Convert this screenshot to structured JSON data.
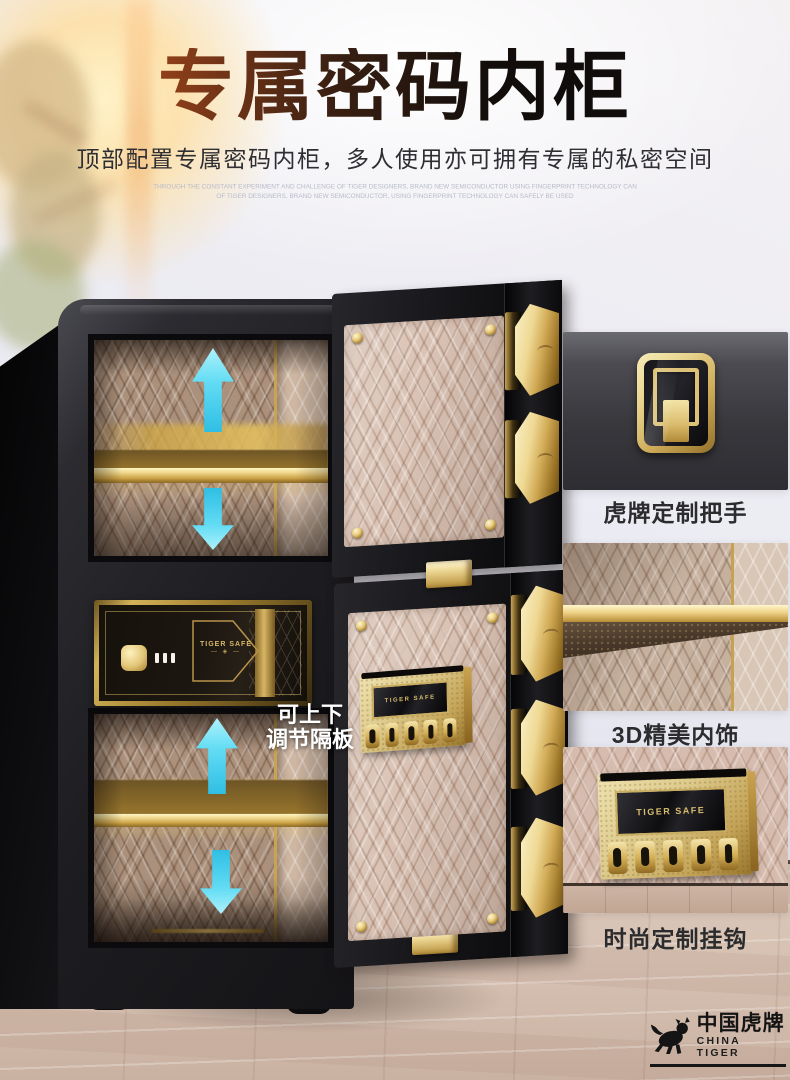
{
  "header": {
    "title": "专属密码内柜",
    "subtitle": "顶部配置专属密码内柜，多人使用亦可拥有专属的私密空间",
    "fineprint_line1": "THROUGH THE CONSTANT EXPERIMENT AND CHALLENGE OF TIGER DESIGNERS, BRAND NEW SEMICONDUCTOR USING FINGERPRINT TECHNOLOGY CAN",
    "fineprint_line2": "OF TIGER DESIGNERS, BRAND NEW SEMICONDUCTOR, USING FINGERPRINT TECHNOLOGY CAN SAFELY BE USED"
  },
  "safe": {
    "inner_cabinet_brand": "TIGER SAFE",
    "inner_cabinet_ornament": "— ◈ —",
    "hook_panel_brand": "TIGER SAFE",
    "shelf_note_line1": "可上下",
    "shelf_note_line2": "调节隔板"
  },
  "callouts": [
    {
      "label": "虎牌定制把手"
    },
    {
      "label": "3D精美内饰"
    },
    {
      "label": "时尚定制挂钩",
      "brand": "TIGER SAFE"
    }
  ],
  "logo": {
    "name_cn": "中国虎牌",
    "name_en": "CHINA TIGER"
  },
  "icons": {
    "shelf_adjust_up": "up-arrow",
    "shelf_adjust_down": "down-arrow",
    "brand_mark": "tiger-silhouette"
  },
  "colors": {
    "title_gradient_start": "#c6591e",
    "title_gradient_end": "#0b0b0b",
    "arrow_cyan": "#49cdec",
    "accent_gold": "#d5b262",
    "quilt_beige": "#c9b29f",
    "wall": "#e9e9f1",
    "floor_wood": "#d7c3b5"
  }
}
